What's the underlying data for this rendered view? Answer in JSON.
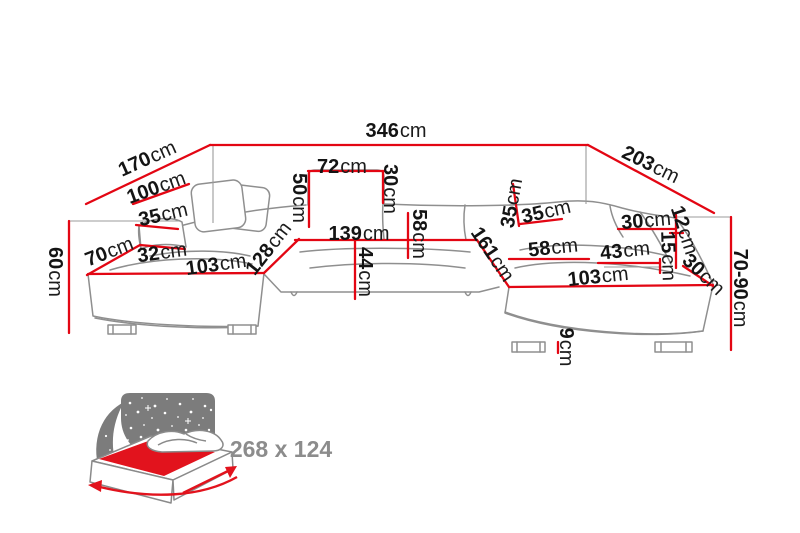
{
  "diagram": {
    "type": "furniture-dimension-diagram",
    "subject": "u-shaped-corner-sofa",
    "unit": "cm",
    "colors": {
      "dimension_line": "#e30613",
      "sofa_outline": "#8f8f8f",
      "label_text": "#141414",
      "muted_text": "#8c8c8c",
      "night_panel": "#7c7c7c",
      "mattress_red": "#e2131d",
      "background": "#ffffff"
    },
    "dimensions": [
      {
        "id": "dim-346",
        "value": "346",
        "unit": "cm"
      },
      {
        "id": "dim-170",
        "value": "170",
        "unit": "cm"
      },
      {
        "id": "dim-203",
        "value": "203",
        "unit": "cm"
      },
      {
        "id": "dim-100",
        "value": "100",
        "unit": "cm"
      },
      {
        "id": "dim-35-left",
        "value": "35",
        "unit": "cm"
      },
      {
        "id": "dim-70-left",
        "value": "70",
        "unit": "cm"
      },
      {
        "id": "dim-32",
        "value": "32",
        "unit": "cm"
      },
      {
        "id": "dim-103-left",
        "value": "103",
        "unit": "cm"
      },
      {
        "id": "dim-60",
        "value": "60",
        "unit": "cm"
      },
      {
        "id": "dim-128",
        "value": "128",
        "unit": "cm"
      },
      {
        "id": "dim-50",
        "value": "50",
        "unit": "cm"
      },
      {
        "id": "dim-72",
        "value": "72",
        "unit": "cm"
      },
      {
        "id": "dim-30-headrest",
        "value": "30",
        "unit": "cm"
      },
      {
        "id": "dim-139",
        "value": "139",
        "unit": "cm"
      },
      {
        "id": "dim-58-mid",
        "value": "58",
        "unit": "cm"
      },
      {
        "id": "dim-44",
        "value": "44",
        "unit": "cm"
      },
      {
        "id": "dim-161",
        "value": "161",
        "unit": "cm"
      },
      {
        "id": "dim-35-corner",
        "value": "35",
        "unit": "cm"
      },
      {
        "id": "dim-35-right",
        "value": "35",
        "unit": "cm"
      },
      {
        "id": "dim-30-right",
        "value": "30",
        "unit": "cm"
      },
      {
        "id": "dim-58-right",
        "value": "58",
        "unit": "cm"
      },
      {
        "id": "dim-43",
        "value": "43",
        "unit": "cm"
      },
      {
        "id": "dim-103-right",
        "value": "103",
        "unit": "cm"
      },
      {
        "id": "dim-12",
        "value": "12",
        "unit": "cm"
      },
      {
        "id": "dim-15",
        "value": "15",
        "unit": "cm"
      },
      {
        "id": "dim-30-corner",
        "value": "30",
        "unit": "cm"
      },
      {
        "id": "dim-70-90",
        "value": "70-90",
        "unit": "cm"
      },
      {
        "id": "dim-9",
        "value": "9",
        "unit": "cm"
      }
    ],
    "sleeping_size": {
      "label": "268 x 124"
    }
  }
}
